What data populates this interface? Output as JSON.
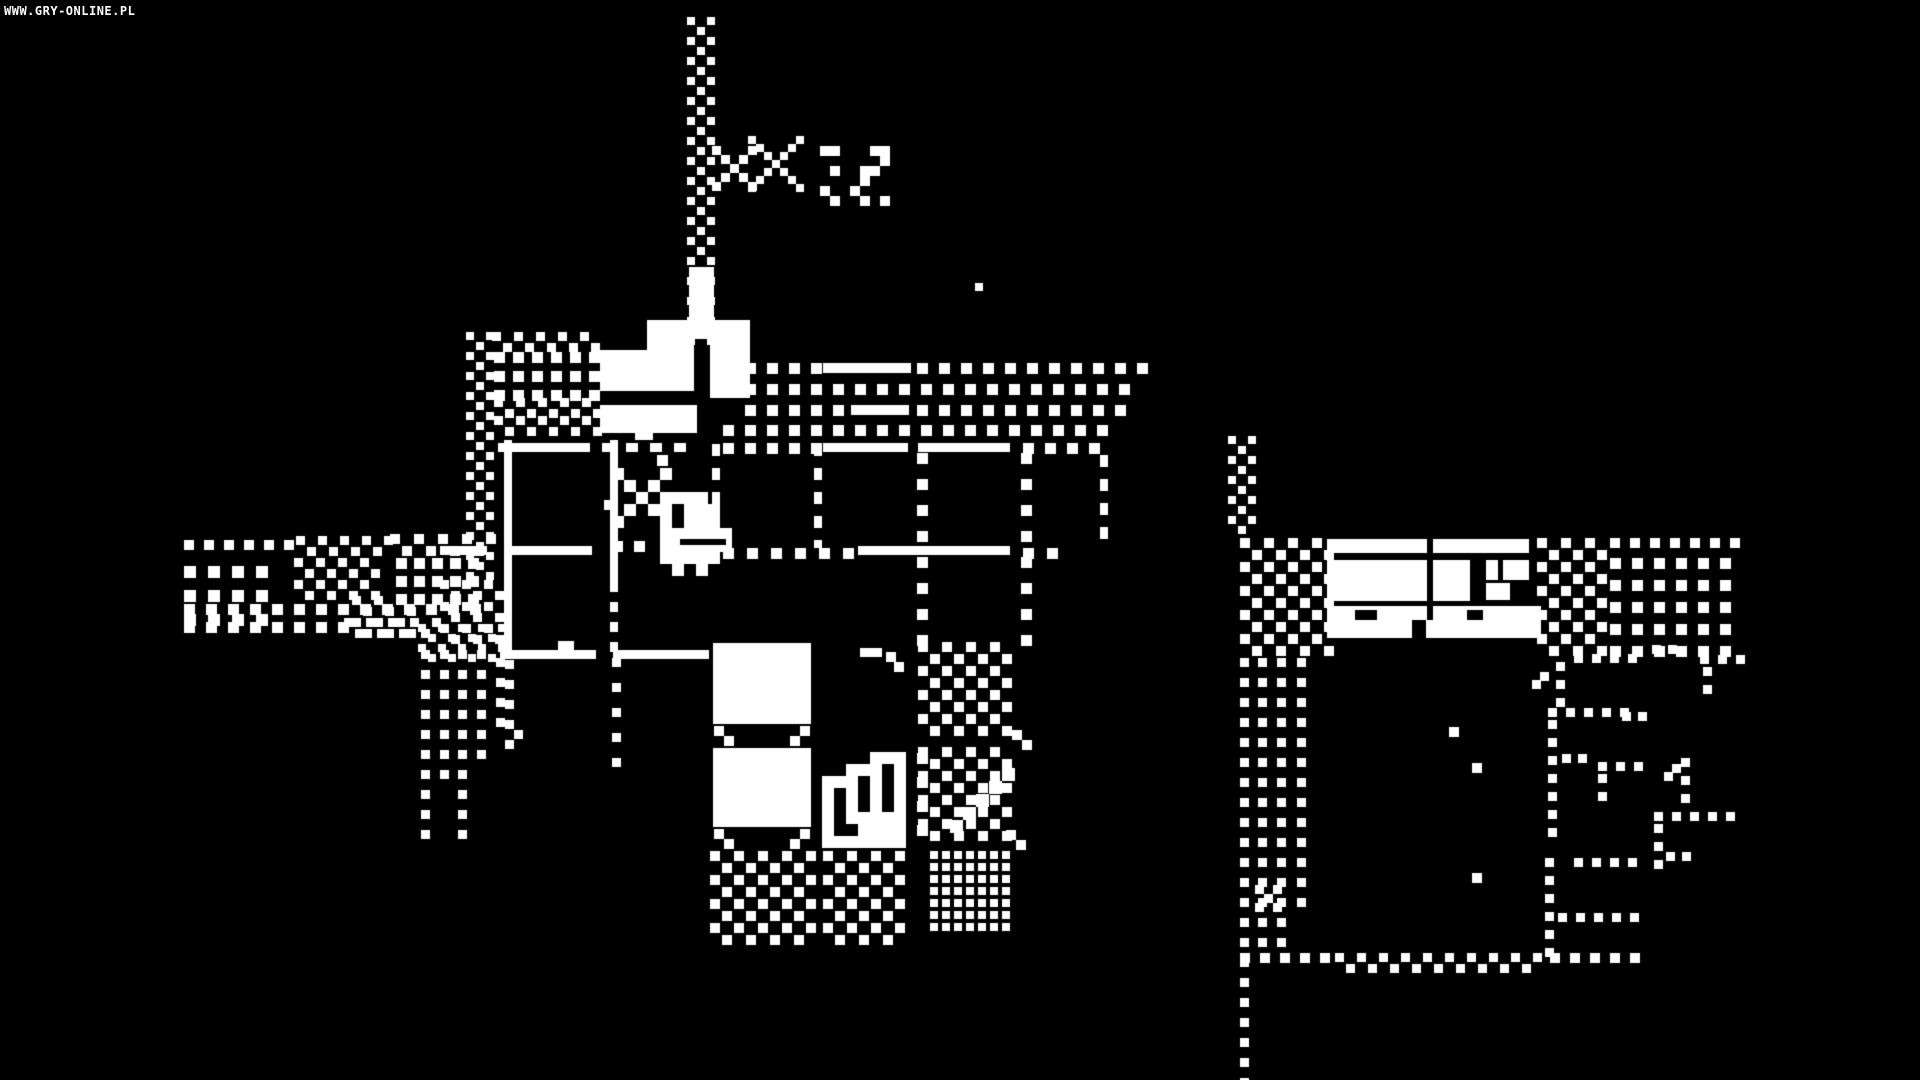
{
  "watermark": "WWW.GRY-ONLINE.PL",
  "scene": {
    "width": 1920,
    "height": 1080,
    "background": "#000000",
    "foreground": "#ffffff",
    "description": "1-bit monochrome adventure game scene: sword-carrying duck hero inside a tiled building with flag pole, dithered paths and a second building to the east"
  },
  "sprites": {
    "player": {
      "cell": 12,
      "map": [
        "1...1.........",
        ".1.1..........",
        "..1.1111......",
        ".1.118111.....",
        "1...18111.....",
        "....111111....",
        "....111111....",
        "....11111.....",
        ".....1.1......"
      ]
    },
    "stairs": {
      "cell": 12,
      "map": [
        "....111",
        "..111.1",
        "111.1.1",
        "1.1.1.1",
        "1.1.1.1",
        "1.11111",
        "1..1111",
        "1111111"
      ]
    },
    "starA": {
      "cell": 9,
      "map": [
        "1...1",
        ".1.1.",
        "..1..",
        ".1.1.",
        "1...1"
      ]
    },
    "starB": {
      "cell": 8,
      "map": [
        "1.....1",
        ".1...1.",
        "..1.1..",
        "...1...",
        "..1.1..",
        ".1...1.",
        "1.....1"
      ]
    },
    "sparkC": {
      "cell": 10,
      "map": [
        "11...11",
        "......1",
        ".1..11.",
        "....1..",
        "1..1...",
        ".1..1.1"
      ]
    },
    "xglyph": {
      "cell": 9,
      "map": [
        "1.1",
        ".1.",
        "1.1"
      ]
    }
  },
  "primitives": [
    {
      "t": "checker",
      "x": 687,
      "y": 17,
      "w": 22,
      "h": 322,
      "c": 10,
      "d": 8
    },
    {
      "t": "solid",
      "x": 689,
      "y": 267,
      "w": 25,
      "h": 72
    },
    {
      "t": "solid",
      "x": 647,
      "y": 320,
      "w": 47,
      "h": 32
    },
    {
      "t": "solid",
      "x": 710,
      "y": 320,
      "w": 40,
      "h": 78
    },
    {
      "t": "solid",
      "x": 600,
      "y": 350,
      "w": 94,
      "h": 41
    },
    {
      "t": "solid",
      "x": 600,
      "y": 405,
      "w": 97,
      "h": 28
    },
    {
      "t": "solid",
      "x": 635,
      "y": 433,
      "w": 18,
      "h": 7
    },
    {
      "t": "spr",
      "name": "starA",
      "x": 712,
      "y": 146
    },
    {
      "t": "spr",
      "name": "starB",
      "x": 748,
      "y": 136
    },
    {
      "t": "spr",
      "name": "sparkC",
      "x": 820,
      "y": 146
    },
    {
      "t": "zig",
      "x": 492,
      "y": 332,
      "w": 102,
      "c": 11,
      "d": 9
    },
    {
      "t": "grid",
      "x": 494,
      "y": 352,
      "w": 102,
      "h": 40,
      "pc": 19,
      "d": 11
    },
    {
      "t": "zig",
      "x": 494,
      "y": 398,
      "w": 102,
      "c": 11,
      "d": 9
    },
    {
      "t": "zig",
      "x": 494,
      "y": 416,
      "w": 102,
      "c": 11,
      "d": 9
    },
    {
      "t": "checker",
      "x": 466,
      "y": 332,
      "w": 22,
      "h": 250,
      "c": 10,
      "d": 8
    },
    {
      "t": "checker",
      "x": 440,
      "y": 580,
      "w": 58,
      "h": 66,
      "c": 11,
      "d": 9
    },
    {
      "t": "vdots",
      "x": 421,
      "y": 650,
      "h": 200,
      "p": 20,
      "d": 9
    },
    {
      "t": "vdots",
      "x": 440,
      "y": 650,
      "h": 134,
      "p": 20,
      "d": 9
    },
    {
      "t": "vdots",
      "x": 458,
      "y": 650,
      "h": 200,
      "p": 20,
      "d": 9
    },
    {
      "t": "vdots",
      "x": 477,
      "y": 650,
      "h": 112,
      "p": 20,
      "d": 9
    },
    {
      "t": "vdots",
      "x": 496,
      "y": 658,
      "h": 80,
      "p": 20,
      "d": 9
    },
    {
      "t": "vdots",
      "x": 505,
      "y": 660,
      "h": 84,
      "p": 20,
      "d": 9
    },
    {
      "t": "dot",
      "x": 514,
      "y": 730,
      "d": 9
    },
    {
      "t": "hdots",
      "x": 184,
      "y": 540,
      "w": 112,
      "p": 20,
      "d": 10
    },
    {
      "t": "zig",
      "x": 296,
      "y": 536,
      "w": 92,
      "c": 11,
      "d": 9
    },
    {
      "t": "zig",
      "x": 390,
      "y": 534,
      "w": 100,
      "c": 12,
      "d": 10
    },
    {
      "t": "grid",
      "x": 184,
      "y": 566,
      "w": 88,
      "h": 72,
      "pc": 24,
      "d": 12
    },
    {
      "t": "checker",
      "x": 294,
      "y": 558,
      "w": 88,
      "h": 44,
      "c": 11,
      "d": 9
    },
    {
      "t": "grid",
      "x": 396,
      "y": 558,
      "w": 86,
      "h": 44,
      "pc": 18,
      "d": 11
    },
    {
      "t": "hdots",
      "x": 184,
      "y": 604,
      "w": 300,
      "p": 22,
      "d": 11
    },
    {
      "t": "checker",
      "x": 352,
      "y": 596,
      "w": 66,
      "h": 40,
      "c": 11,
      "d": 9
    },
    {
      "t": "hdots",
      "x": 184,
      "y": 622,
      "w": 162,
      "p": 22,
      "d": 11
    },
    {
      "t": "zig",
      "x": 344,
      "y": 618,
      "w": 92,
      "c": 11,
      "d": 9
    },
    {
      "t": "checker",
      "x": 418,
      "y": 624,
      "w": 82,
      "h": 32,
      "c": 10,
      "d": 8
    },
    {
      "t": "solid",
      "x": 504,
      "y": 440,
      "w": 8,
      "h": 214
    },
    {
      "t": "solid",
      "x": 610,
      "y": 440,
      "w": 8,
      "h": 142
    },
    {
      "t": "vdash",
      "x": 610,
      "y": 582,
      "w": 8,
      "h": 72,
      "p": 20,
      "on": 10
    },
    {
      "t": "vdots",
      "x": 612,
      "y": 658,
      "h": 124,
      "p": 25,
      "d": 9
    },
    {
      "t": "vdash",
      "x": 712,
      "y": 444,
      "w": 8,
      "h": 104,
      "p": 24,
      "on": 12
    },
    {
      "t": "vdash",
      "x": 814,
      "y": 444,
      "w": 8,
      "h": 104,
      "p": 24,
      "on": 12
    },
    {
      "t": "vdots",
      "x": 917,
      "y": 453,
      "h": 196,
      "p": 26,
      "d": 11
    },
    {
      "t": "vdots",
      "x": 1021,
      "y": 453,
      "h": 196,
      "p": 26,
      "d": 11
    },
    {
      "t": "vdash",
      "x": 1100,
      "y": 455,
      "w": 8,
      "h": 92,
      "p": 24,
      "on": 12
    },
    {
      "t": "hdots",
      "x": 723,
      "y": 363,
      "w": 98,
      "p": 22,
      "d": 11
    },
    {
      "t": "solid",
      "x": 823,
      "y": 363,
      "w": 88,
      "h": 10
    },
    {
      "t": "hdots",
      "x": 917,
      "y": 363,
      "w": 232,
      "p": 22,
      "d": 11
    },
    {
      "t": "hdots",
      "x": 723,
      "y": 384,
      "w": 404,
      "p": 22,
      "d": 11
    },
    {
      "t": "hdots",
      "x": 745,
      "y": 405,
      "w": 106,
      "p": 22,
      "d": 11
    },
    {
      "t": "solid",
      "x": 851,
      "y": 405,
      "w": 58,
      "h": 10
    },
    {
      "t": "hdots",
      "x": 917,
      "y": 405,
      "w": 204,
      "p": 22,
      "d": 11
    },
    {
      "t": "hdots",
      "x": 723,
      "y": 425,
      "w": 394,
      "p": 22,
      "d": 11
    },
    {
      "t": "solid",
      "x": 498,
      "y": 443,
      "w": 92,
      "h": 9
    },
    {
      "t": "hdash",
      "x": 602,
      "y": 443,
      "w": 88,
      "h": 9,
      "p": 24,
      "on": 12
    },
    {
      "t": "hdots",
      "x": 723,
      "y": 443,
      "w": 98,
      "p": 22,
      "d": 11
    },
    {
      "t": "solid",
      "x": 823,
      "y": 443,
      "w": 85,
      "h": 9
    },
    {
      "t": "solid",
      "x": 918,
      "y": 443,
      "w": 92,
      "h": 9
    },
    {
      "t": "hdots",
      "x": 1023,
      "y": 443,
      "w": 82,
      "p": 22,
      "d": 11
    },
    {
      "t": "dot",
      "x": 657,
      "y": 455,
      "d": 11
    },
    {
      "t": "solid",
      "x": 440,
      "y": 546,
      "w": 47,
      "h": 9
    },
    {
      "t": "solid",
      "x": 504,
      "y": 546,
      "w": 88,
      "h": 9
    },
    {
      "t": "hdots",
      "x": 612,
      "y": 541,
      "w": 44,
      "p": 22,
      "d": 11
    },
    {
      "t": "solid",
      "x": 660,
      "y": 546,
      "w": 48,
      "h": 9
    },
    {
      "t": "hdots",
      "x": 723,
      "y": 548,
      "w": 132,
      "p": 24,
      "d": 11
    },
    {
      "t": "solid",
      "x": 858,
      "y": 546,
      "w": 152,
      "h": 9
    },
    {
      "t": "hdots",
      "x": 1023,
      "y": 548,
      "w": 46,
      "p": 24,
      "d": 11
    },
    {
      "t": "solid",
      "x": 500,
      "y": 650,
      "w": 96,
      "h": 9
    },
    {
      "t": "solid",
      "x": 558,
      "y": 641,
      "w": 16,
      "h": 9
    },
    {
      "t": "solid",
      "x": 613,
      "y": 650,
      "w": 96,
      "h": 9
    },
    {
      "t": "solid",
      "x": 860,
      "y": 648,
      "w": 22,
      "h": 9
    },
    {
      "t": "dot",
      "x": 886,
      "y": 652,
      "d": 10
    },
    {
      "t": "dot",
      "x": 894,
      "y": 662,
      "d": 10
    },
    {
      "t": "solid",
      "x": 713,
      "y": 643,
      "w": 98,
      "h": 81
    },
    {
      "t": "dot",
      "x": 714,
      "y": 726,
      "d": 10
    },
    {
      "t": "dot",
      "x": 724,
      "y": 736,
      "d": 10
    },
    {
      "t": "dot",
      "x": 800,
      "y": 726,
      "d": 10
    },
    {
      "t": "dot",
      "x": 790,
      "y": 736,
      "d": 10
    },
    {
      "t": "solid",
      "x": 713,
      "y": 748,
      "w": 98,
      "h": 79
    },
    {
      "t": "dot",
      "x": 714,
      "y": 829,
      "d": 10
    },
    {
      "t": "dot",
      "x": 724,
      "y": 839,
      "d": 10
    },
    {
      "t": "dot",
      "x": 800,
      "y": 829,
      "d": 10
    },
    {
      "t": "dot",
      "x": 790,
      "y": 839,
      "d": 10
    },
    {
      "t": "spr",
      "name": "stairs",
      "x": 822,
      "y": 752
    },
    {
      "t": "vdots",
      "x": 917,
      "y": 753,
      "h": 94,
      "p": 24,
      "d": 11
    },
    {
      "t": "checker",
      "x": 918,
      "y": 642,
      "w": 96,
      "h": 90,
      "c": 12,
      "d": 10
    },
    {
      "t": "dot",
      "x": 1012,
      "y": 730,
      "d": 10
    },
    {
      "t": "dot",
      "x": 1022,
      "y": 740,
      "d": 10
    },
    {
      "t": "checker",
      "x": 918,
      "y": 747,
      "w": 96,
      "h": 96,
      "c": 12,
      "d": 10
    },
    {
      "t": "solid",
      "x": 950,
      "y": 820,
      "w": 13,
      "h": 13
    },
    {
      "t": "solid",
      "x": 963,
      "y": 807,
      "w": 13,
      "h": 13
    },
    {
      "t": "solid",
      "x": 976,
      "y": 794,
      "w": 13,
      "h": 13
    },
    {
      "t": "solid",
      "x": 989,
      "y": 781,
      "w": 13,
      "h": 13
    },
    {
      "t": "solid",
      "x": 1002,
      "y": 768,
      "w": 13,
      "h": 13
    },
    {
      "t": "dot",
      "x": 1006,
      "y": 830,
      "d": 10
    },
    {
      "t": "dot",
      "x": 1016,
      "y": 840,
      "d": 10
    },
    {
      "t": "checker",
      "x": 710,
      "y": 851,
      "w": 108,
      "h": 90,
      "c": 12,
      "d": 10
    },
    {
      "t": "checker",
      "x": 823,
      "y": 851,
      "w": 82,
      "h": 88,
      "c": 12,
      "d": 10
    },
    {
      "t": "grid",
      "x": 930,
      "y": 851,
      "w": 76,
      "h": 78,
      "pc": 12,
      "d": 8
    },
    {
      "t": "checker",
      "x": 1228,
      "y": 436,
      "w": 24,
      "h": 100,
      "c": 10,
      "d": 8
    },
    {
      "t": "checker",
      "x": 1240,
      "y": 538,
      "w": 86,
      "h": 118,
      "c": 12,
      "d": 10
    },
    {
      "t": "solid",
      "x": 1327,
      "y": 539,
      "w": 100,
      "h": 14
    },
    {
      "t": "solid",
      "x": 1433,
      "y": 539,
      "w": 96,
      "h": 14
    },
    {
      "t": "solid",
      "x": 1327,
      "y": 560,
      "w": 100,
      "h": 41
    },
    {
      "t": "solid",
      "x": 1433,
      "y": 560,
      "w": 37,
      "h": 41
    },
    {
      "t": "solid",
      "x": 1486,
      "y": 560,
      "w": 12,
      "h": 20
    },
    {
      "t": "solid",
      "x": 1503,
      "y": 560,
      "w": 26,
      "h": 20
    },
    {
      "t": "solid",
      "x": 1486,
      "y": 583,
      "w": 24,
      "h": 17
    },
    {
      "t": "solid",
      "x": 1327,
      "y": 606,
      "w": 100,
      "h": 14
    },
    {
      "t": "solid",
      "x": 1433,
      "y": 606,
      "w": 108,
      "h": 14
    },
    {
      "t": "solid",
      "x": 1327,
      "y": 620,
      "w": 214,
      "h": 18
    },
    {
      "t": "black",
      "x": 1355,
      "y": 610,
      "w": 22,
      "h": 10
    },
    {
      "t": "black",
      "x": 1467,
      "y": 610,
      "w": 16,
      "h": 10
    },
    {
      "t": "black",
      "x": 1412,
      "y": 620,
      "w": 14,
      "h": 18
    },
    {
      "t": "checker",
      "x": 1537,
      "y": 538,
      "w": 72,
      "h": 118,
      "c": 12,
      "d": 10
    },
    {
      "t": "grid",
      "x": 1610,
      "y": 558,
      "w": 130,
      "h": 98,
      "pc": 22,
      "d": 11
    },
    {
      "t": "hdots",
      "x": 1610,
      "y": 538,
      "w": 130,
      "p": 20,
      "d": 10
    },
    {
      "t": "vdots",
      "x": 1240,
      "y": 658,
      "h": 422,
      "p": 20,
      "d": 9
    },
    {
      "t": "vdots",
      "x": 1258,
      "y": 658,
      "h": 290,
      "p": 20,
      "d": 9
    },
    {
      "t": "vdots",
      "x": 1277,
      "y": 658,
      "h": 295,
      "p": 20,
      "d": 9
    },
    {
      "t": "vdots",
      "x": 1297,
      "y": 658,
      "h": 250,
      "p": 20,
      "d": 9
    },
    {
      "t": "spr",
      "name": "xglyph",
      "x": 1255,
      "y": 885
    },
    {
      "t": "hdots",
      "x": 1240,
      "y": 953,
      "w": 92,
      "p": 20,
      "d": 10
    },
    {
      "t": "zig",
      "x": 1335,
      "y": 953,
      "w": 202,
      "c": 11,
      "d": 9
    },
    {
      "t": "hdots",
      "x": 1550,
      "y": 953,
      "w": 92,
      "p": 20,
      "d": 10
    },
    {
      "t": "hdots",
      "x": 1574,
      "y": 654,
      "w": 66,
      "p": 18,
      "d": 9
    },
    {
      "t": "vdots",
      "x": 1556,
      "y": 662,
      "h": 40,
      "p": 18,
      "d": 9
    },
    {
      "t": "dot",
      "x": 1540,
      "y": 672,
      "d": 9
    },
    {
      "t": "dot",
      "x": 1532,
      "y": 680,
      "d": 9
    },
    {
      "t": "hdots",
      "x": 1700,
      "y": 655,
      "w": 38,
      "p": 18,
      "d": 9
    },
    {
      "t": "vdots",
      "x": 1703,
      "y": 667,
      "h": 34,
      "p": 18,
      "d": 9
    },
    {
      "t": "dot",
      "x": 1652,
      "y": 645,
      "d": 9
    },
    {
      "t": "dot",
      "x": 1668,
      "y": 645,
      "d": 9
    },
    {
      "t": "hdots",
      "x": 1548,
      "y": 708,
      "w": 84,
      "p": 18,
      "d": 9
    },
    {
      "t": "vdots",
      "x": 1548,
      "y": 720,
      "h": 112,
      "p": 18,
      "d": 9
    },
    {
      "t": "hdots",
      "x": 1562,
      "y": 754,
      "w": 32,
      "p": 16,
      "d": 9
    },
    {
      "t": "hdots",
      "x": 1598,
      "y": 762,
      "w": 44,
      "p": 18,
      "d": 9
    },
    {
      "t": "vdots",
      "x": 1598,
      "y": 774,
      "h": 36,
      "p": 18,
      "d": 9
    },
    {
      "t": "vdots",
      "x": 1681,
      "y": 758,
      "h": 52,
      "p": 18,
      "d": 9
    },
    {
      "t": "dot",
      "x": 1672,
      "y": 764,
      "d": 9
    },
    {
      "t": "dot",
      "x": 1664,
      "y": 772,
      "d": 9
    },
    {
      "t": "hdots",
      "x": 1654,
      "y": 812,
      "w": 74,
      "p": 18,
      "d": 9
    },
    {
      "t": "vdots",
      "x": 1654,
      "y": 824,
      "h": 46,
      "p": 18,
      "d": 9
    },
    {
      "t": "hdots",
      "x": 1666,
      "y": 852,
      "w": 28,
      "p": 16,
      "d": 9
    },
    {
      "t": "vdots",
      "x": 1545,
      "y": 858,
      "h": 100,
      "p": 18,
      "d": 9
    },
    {
      "t": "hdots",
      "x": 1574,
      "y": 858,
      "w": 68,
      "p": 18,
      "d": 9
    },
    {
      "t": "hdots",
      "x": 1558,
      "y": 913,
      "w": 82,
      "p": 18,
      "d": 9
    },
    {
      "t": "dot",
      "x": 1622,
      "y": 712,
      "d": 9
    },
    {
      "t": "dot",
      "x": 1638,
      "y": 712,
      "d": 9
    },
    {
      "t": "dot",
      "x": 1449,
      "y": 727,
      "d": 10
    },
    {
      "t": "dot",
      "x": 1472,
      "y": 763,
      "d": 10
    },
    {
      "t": "dot",
      "x": 1472,
      "y": 873,
      "d": 10
    },
    {
      "t": "dot",
      "x": 975,
      "y": 283,
      "d": 8
    },
    {
      "t": "spr",
      "name": "player",
      "x": 612,
      "y": 468
    },
    {
      "t": "black",
      "x": 680,
      "y": 539,
      "w": 46,
      "h": 6
    },
    {
      "t": "dot",
      "x": 604,
      "y": 500,
      "d": 10
    }
  ]
}
